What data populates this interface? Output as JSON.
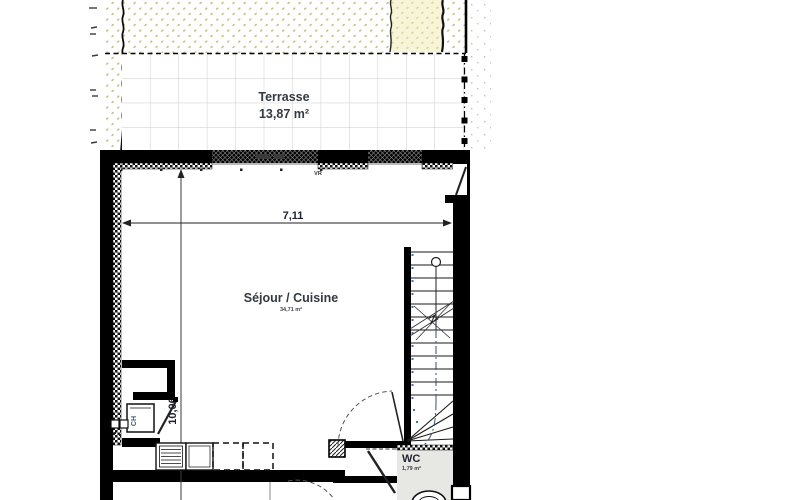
{
  "plan": {
    "rooms": {
      "terrace": {
        "name": "Terrasse",
        "area": "13,87 m²"
      },
      "living": {
        "name": "Séjour / Cuisine",
        "area": "34,71 m²"
      },
      "wc": {
        "name": "WC",
        "area": "1,79 m²"
      },
      "closet": {
        "name": "CH"
      }
    },
    "annotations": {
      "shutter": "VR",
      "dim_width": "7,11",
      "dim_height": "10,06"
    },
    "colors": {
      "wall": "#000000",
      "ground_dot": "#cbc28b",
      "sand_fill": "#f7f4d8",
      "sand_dot": "#ddd492",
      "tile_line": "#c9c9c9",
      "room_label": "#333a41",
      "dimension_text": "#1c2130",
      "step_dot_blue": "#4a6fae",
      "wc_floor": "#e7e7e4"
    }
  }
}
